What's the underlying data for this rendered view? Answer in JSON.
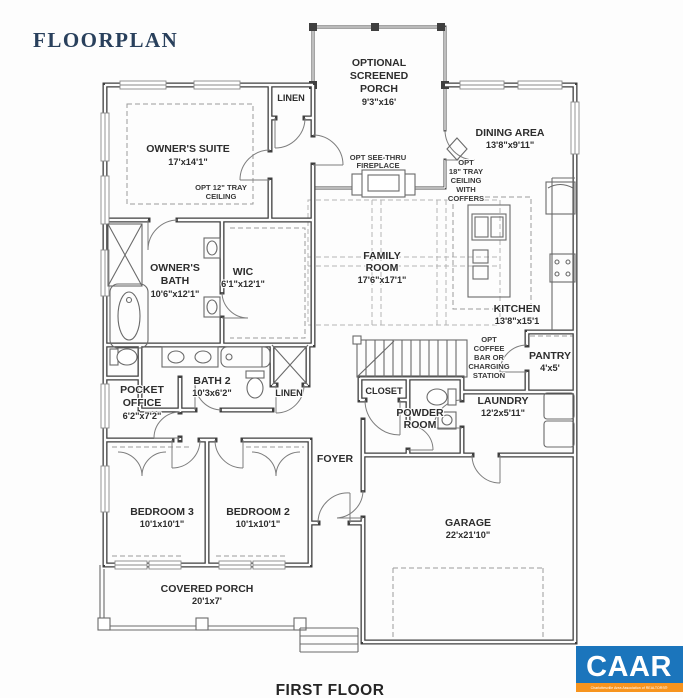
{
  "title": "FLOORPLAN",
  "footer": {
    "label": "FIRST FLOOR"
  },
  "logo": {
    "name": "CAAR",
    "tagline": "Charlottesville Area Association of REALTORS®",
    "blue": "#1b75bc",
    "orange": "#f7941e"
  },
  "rooms": {
    "screened_porch": {
      "l1": "OPTIONAL",
      "l2": "SCREENED",
      "l3": "PORCH",
      "dims": "9'3\"x16'"
    },
    "linen_upper": {
      "name": "LINEN"
    },
    "owners_suite": {
      "name": "OWNER'S SUITE",
      "dims": "17'x14'1\""
    },
    "tray_ceiling_12": {
      "l1": "OPT 12\" TRAY",
      "l2": "CEILING"
    },
    "dining": {
      "name": "DINING AREA",
      "dims": "13'8\"x9'11\""
    },
    "tray_ceiling_18": {
      "l1": "OPT",
      "l2": "18\" TRAY",
      "l3": "CEILING",
      "l4": "WITH",
      "l5": "COFFERS"
    },
    "fireplace": {
      "l1": "OPT SEE-THRU",
      "l2": "FIREPLACE"
    },
    "family": {
      "l1": "FAMILY",
      "l2": "ROOM",
      "dims": "17'6\"x17'1\""
    },
    "kitchen": {
      "name": "KITCHEN",
      "dims": "13'8\"x15'1"
    },
    "owners_bath": {
      "l1": "OWNER'S",
      "l2": "BATH",
      "dims": "10'6\"x12'1\""
    },
    "wic": {
      "name": "WIC",
      "dims": "6'1\"x12'1\""
    },
    "pocket_office": {
      "l1": "POCKET",
      "l2": "OFFICE",
      "dims": "6'2\"x7'2\""
    },
    "bath2": {
      "name": "BATH 2",
      "dims": "10'3x6'2\""
    },
    "linen_lower": {
      "name": "LINEN"
    },
    "coffee_bar": {
      "l1": "OPT",
      "l2": "COFFEE",
      "l3": "BAR OR",
      "l4": "CHARGING",
      "l5": "STATION"
    },
    "closet": {
      "name": "CLOSET"
    },
    "powder": {
      "l1": "POWDER",
      "l2": "ROOM"
    },
    "laundry": {
      "name": "LAUNDRY",
      "dims": "12'2x5'11\""
    },
    "pantry": {
      "name": "PANTRY",
      "dims": "4'x5'"
    },
    "foyer": {
      "name": "FOYER"
    },
    "bedroom3": {
      "name": "BEDROOM 3",
      "dims": "10'1x10'1\""
    },
    "bedroom2": {
      "name": "BEDROOM 2",
      "dims": "10'1x10'1\""
    },
    "covered_porch": {
      "name": "COVERED PORCH",
      "dims": "20'1x7'"
    },
    "garage": {
      "name": "GARAGE",
      "dims": "22'x21'10\""
    }
  }
}
